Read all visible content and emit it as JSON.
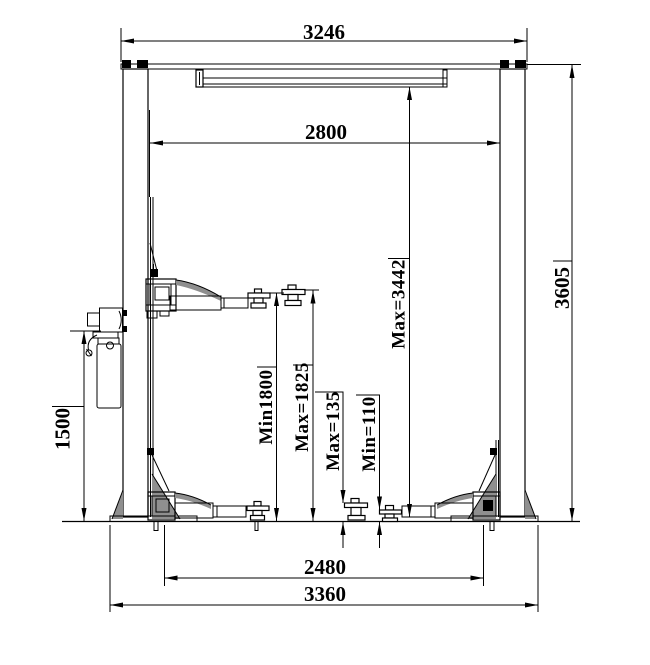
{
  "drawing": {
    "type": "two-post-lift-front-elevation",
    "colors": {
      "line": "#000000",
      "background": "#ffffff",
      "shading": "#8f8f8f"
    }
  },
  "dimensions": {
    "span_top": "3246",
    "span_between_posts": "2800",
    "height_overall": "3605",
    "height_max_clearance": "Max=3442",
    "lift_height_min": "Min1800",
    "lift_height_max": "Max=1825",
    "pad_height_max": "Max=135",
    "pad_height_min": "Min=110",
    "power_unit_height": "1500",
    "span_base_inner": "2480",
    "span_base_overall": "3360"
  }
}
